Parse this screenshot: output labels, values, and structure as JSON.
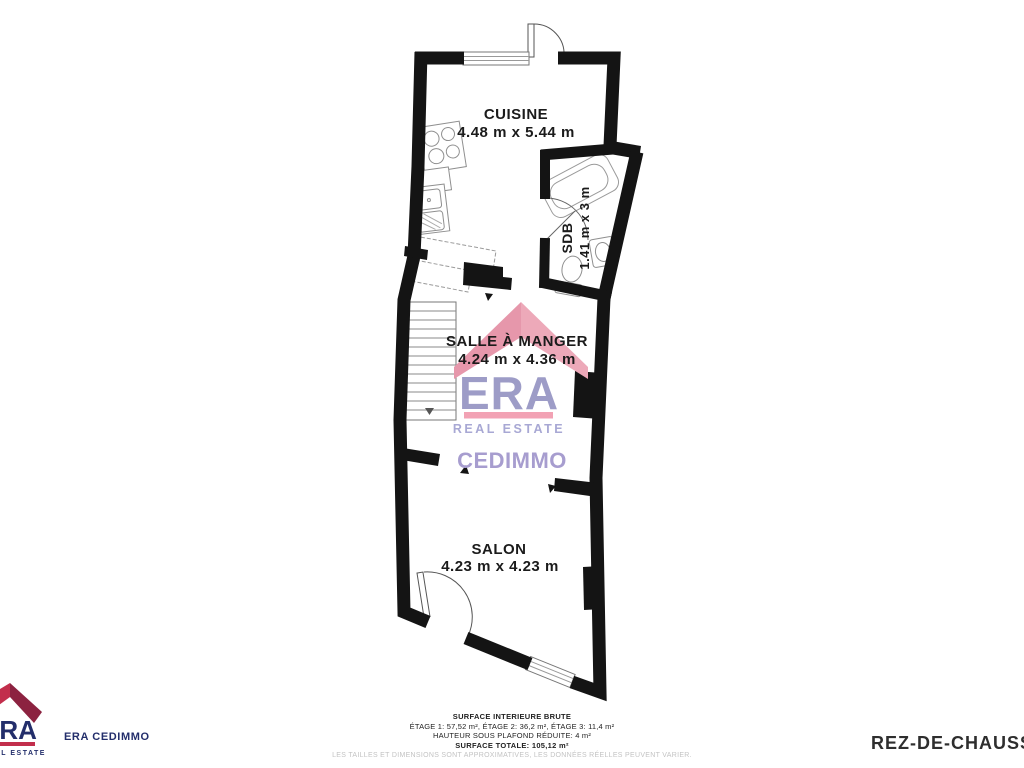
{
  "plan": {
    "rooms": {
      "cuisine": {
        "name": "CUISINE",
        "dims": "4.48 m x 5.44 m"
      },
      "sdb": {
        "name": "SDB",
        "dims": "1.41 m x 3 m"
      },
      "salle_a_manger": {
        "name": "SALLE À MANGER",
        "dims": "4.24 m x 4.36 m"
      },
      "salon": {
        "name": "SALON",
        "dims": "4.23 m x 4.23 m"
      }
    }
  },
  "watermark": {
    "brand": "ERA",
    "tagline": "REAL ESTATE",
    "agency": "CEDIMMO"
  },
  "footer": {
    "logo": {
      "brand": "ERA",
      "tagline": "REAL ESTATE",
      "agency_label": "ERA CEDIMMO"
    },
    "surface": {
      "line1": "SURFACE INTERIEURE BRUTE",
      "line2": "ÉTAGE 1: 57,52 m², ÉTAGE 2: 36,2 m², ÉTAGE 3: 11,4 m²",
      "line3": "HAUTEUR SOUS PLAFOND RÉDUITE: 4 m²",
      "line4": "SURFACE TOTALE: 105,12 m²",
      "disclaimer": "LES TAILLES ET DIMENSIONS SONT APPROXIMATIVES, LES DONNÉES RÉELLES PEUVENT VARIER."
    },
    "floor_label": "REZ-DE-CHAUSSÉE"
  },
  "colors": {
    "wall": "#141414",
    "watermark_pink_left": "#E697AB",
    "watermark_pink_right": "#EDA9B9",
    "watermark_bar_pink": "#F2A2B4",
    "watermark_purple": "#9D9CC7",
    "logo_red": "#C22E4C",
    "logo_dark_red": "#8C2240",
    "logo_navy": "#232E6B"
  }
}
